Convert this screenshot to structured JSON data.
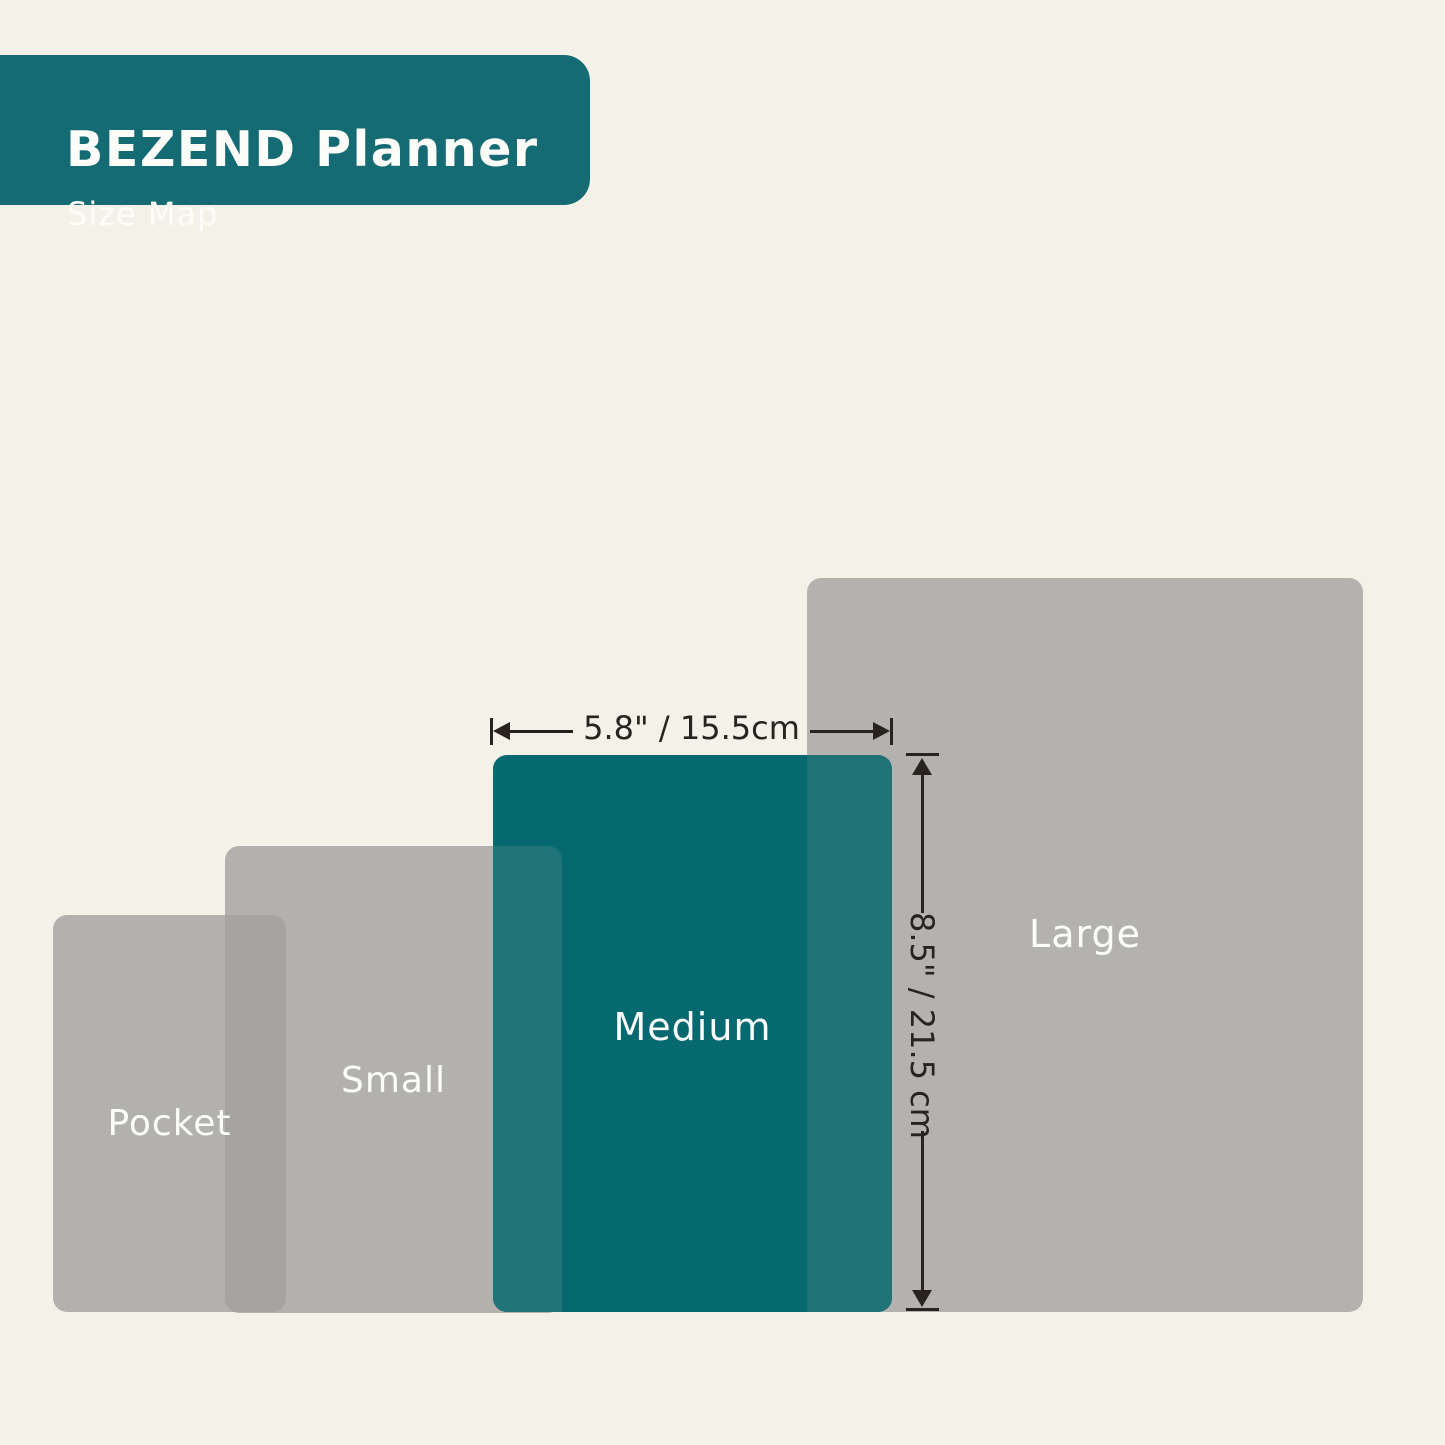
{
  "header": {
    "title": "BEZEND Planner",
    "subtitle": "Size Map"
  },
  "sizes": [
    {
      "name": "Pocket"
    },
    {
      "name": "Small"
    },
    {
      "name": "Medium"
    },
    {
      "name": "Large"
    }
  ],
  "dimensions": {
    "width_label": "5.8\" / 15.5cm",
    "height_label": "8.5\" / 21.5 cm"
  },
  "colors": {
    "background": "#F4F1E8",
    "header_teal": "#146B73",
    "medium_teal": "#05696F",
    "overlap_teal": "#217478",
    "gray_rect": "#B5B3B0",
    "gray_large": "#B4B2AF",
    "gray_overlap": "#A8A6A4",
    "arrow_dark": "#29231F",
    "label_white": "#FCFCFA"
  }
}
